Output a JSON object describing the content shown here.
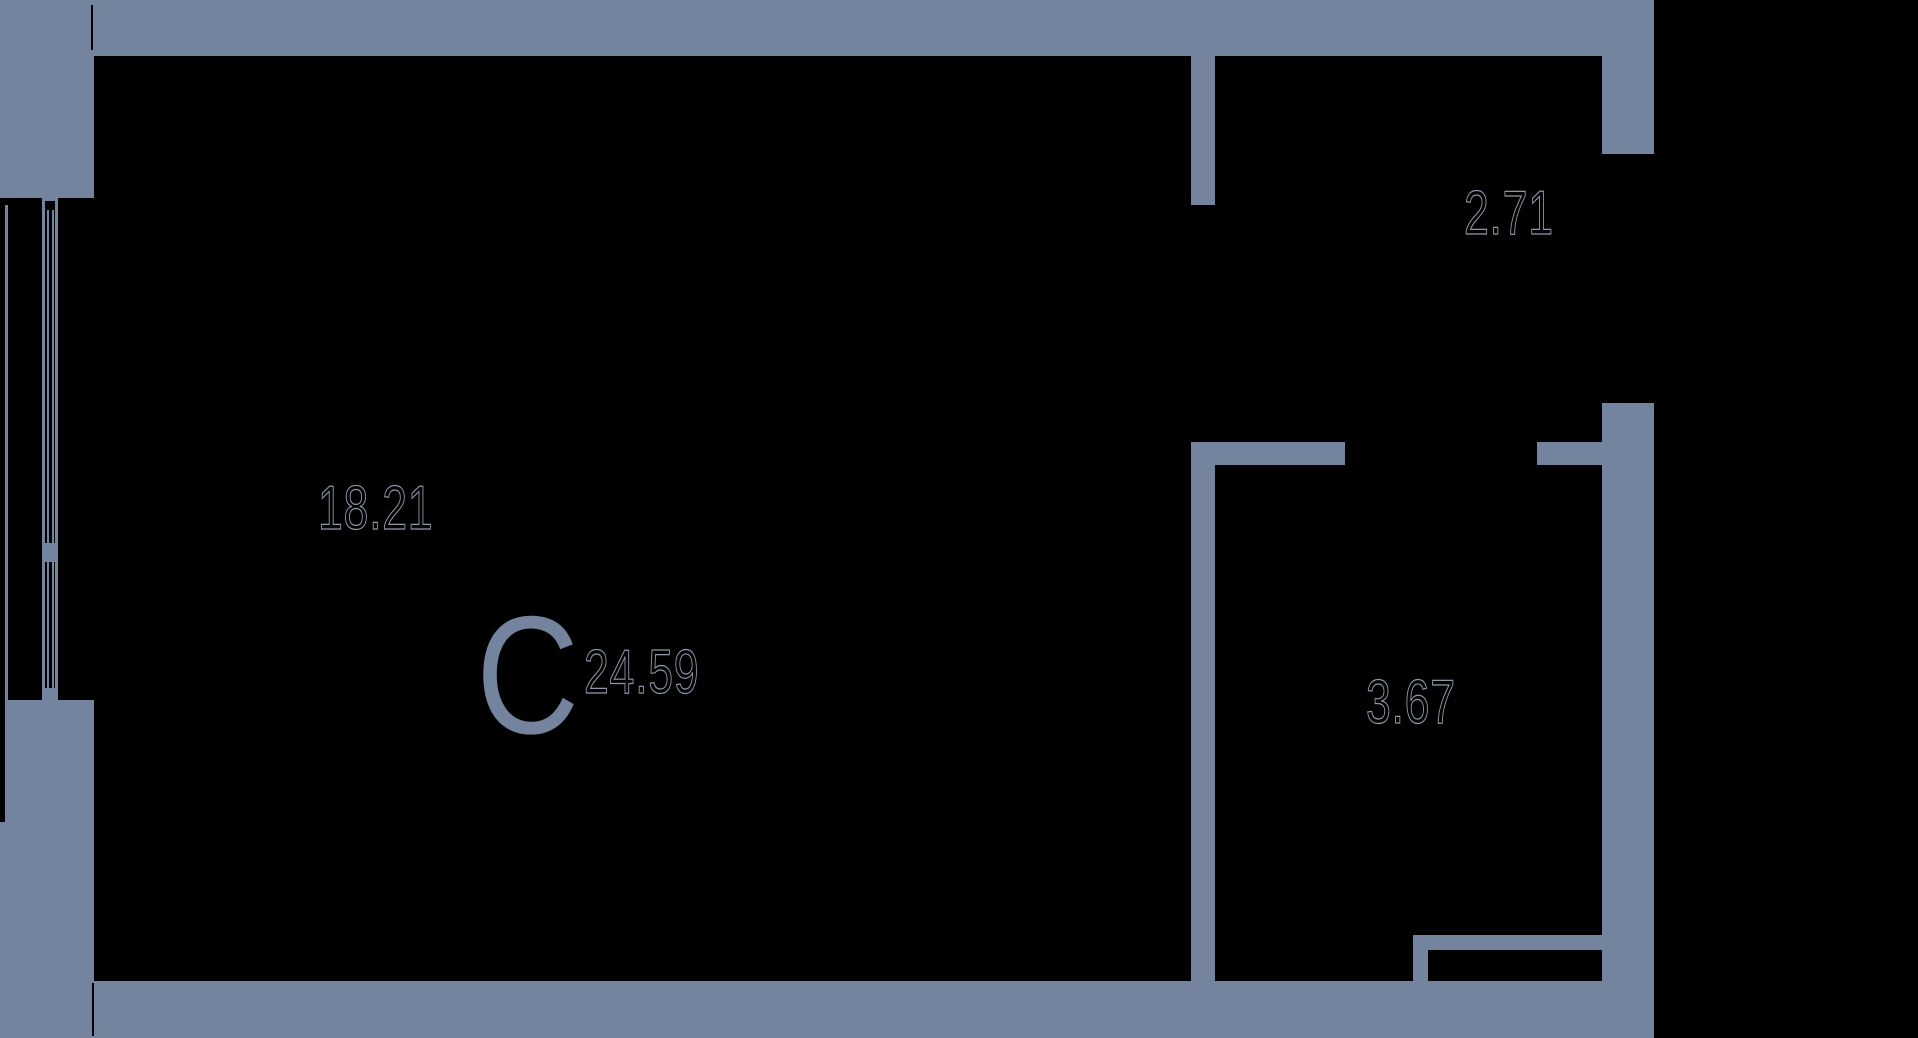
{
  "plan": {
    "type_letter": "С",
    "total_area": "24.59",
    "rooms": [
      {
        "id": "main-room",
        "area": "18.21"
      },
      {
        "id": "hallway",
        "area": "2.71"
      },
      {
        "id": "bathroom",
        "area": "3.67"
      }
    ]
  },
  "colors": {
    "wall": "#74839E",
    "background": "#000000",
    "label_fill": "#000000",
    "label_halo": "#9098A8"
  }
}
